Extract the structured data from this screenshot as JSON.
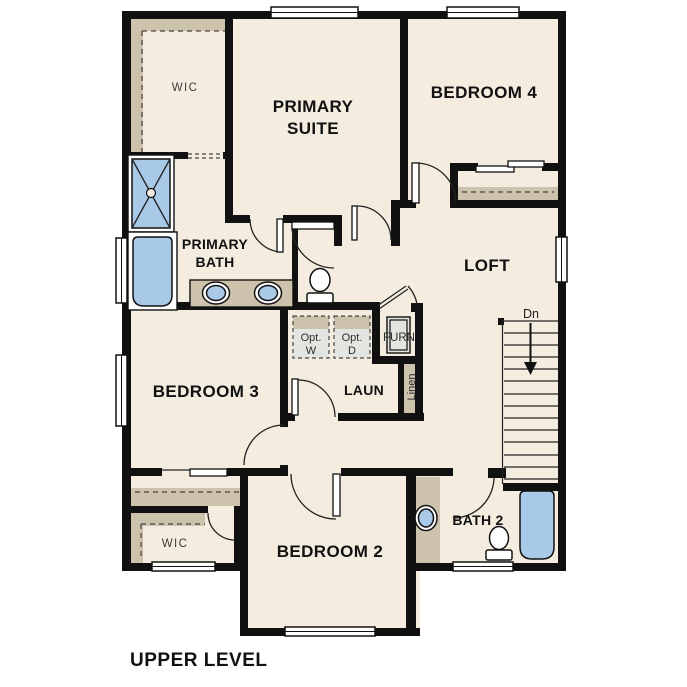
{
  "plan_title": "UPPER LEVEL",
  "colors": {
    "wall": "#111111",
    "floor": "#f3ecdf",
    "tan": "#cdc2ab",
    "blue": "#a9c9e9",
    "gray": "#e4e4e0",
    "line": "#222222",
    "text_dark": "#111111",
    "text_gray": "#3c3c3c"
  },
  "rooms": {
    "wic_primary": {
      "label": "WIC"
    },
    "primary_suite": {
      "line1": "PRIMARY",
      "line2": "SUITE"
    },
    "bedroom4": {
      "label": "BEDROOM 4"
    },
    "primary_bath": {
      "line1": "PRIMARY",
      "line2": "BATH"
    },
    "loft": {
      "label": "LOFT"
    },
    "bedroom3": {
      "label": "BEDROOM 3"
    },
    "laundry": {
      "label": "LAUN"
    },
    "linen_closet": {
      "label": "Linen"
    },
    "furnace_closet": {
      "label": "FURN"
    },
    "optional_washer": {
      "line1": "Opt.",
      "line2": "W"
    },
    "optional_dryer": {
      "line1": "Opt.",
      "line2": "D"
    },
    "bedroom2": {
      "label": "BEDROOM 2"
    },
    "bath2": {
      "label": "BATH 2"
    },
    "wic_bedroom2": {
      "label": "WIC"
    },
    "stairs": {
      "direction_label": "Dn"
    }
  }
}
